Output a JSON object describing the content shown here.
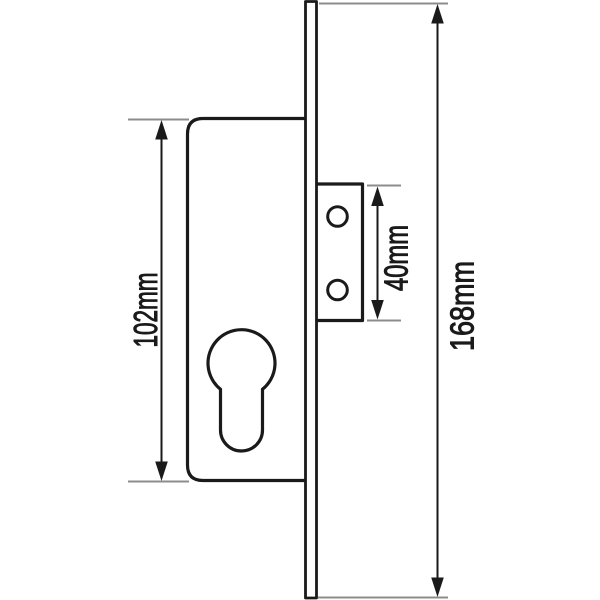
{
  "dimensions": {
    "lock_body_height": {
      "label": "102mm",
      "value_mm": 102
    },
    "bracket_hole_span": {
      "label": "40mm",
      "value_mm": 40
    },
    "faceplate_height": {
      "label": "168mm",
      "value_mm": 168
    }
  },
  "colors": {
    "background": "#ffffff",
    "outline": "#1a1a1a",
    "dimension": "#1a1a1a",
    "extension": "#8c8c8c",
    "label_text": "#1a1a1a"
  }
}
